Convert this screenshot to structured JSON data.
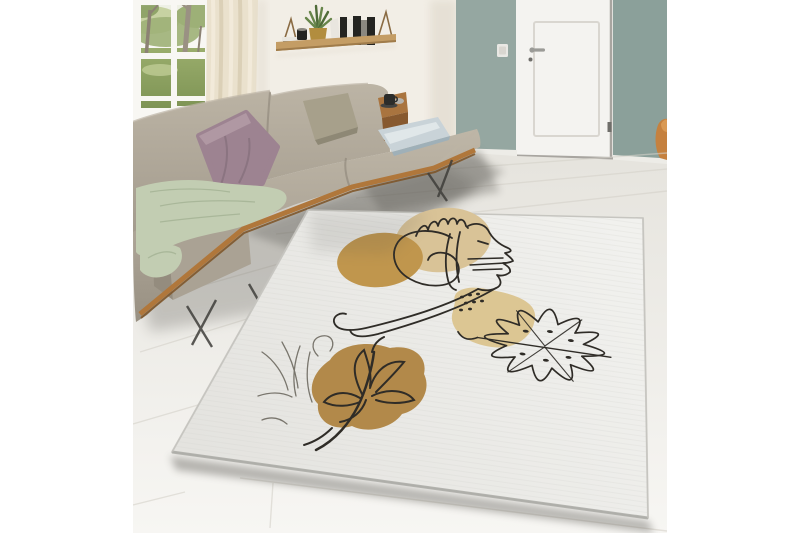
{
  "scene": {
    "setting": "bright living room lifestyle photo showcasing an abstract line-art area rug",
    "objects": {
      "window": "garden view with tree trunks and green lawn",
      "curtain": "cream linen curtain",
      "shelf": "hanging wooden wall shelf with books, succulent plant, gold pot and black canister",
      "sofa": "greige fabric corner sofa with wooden base rail and metal legs",
      "pillows": [
        "mauve velvet pillow",
        "sage-taupe pillow",
        "light blue satin pillow"
      ],
      "throw": "sage green knit throw",
      "side_table": "walnut side shelf with black espresso cup",
      "door": "white panel interior door with lever handle",
      "accent_wall": "sage-green recessed wall around door",
      "light_switch": "white switch on accent wall",
      "chair_glimpse": "orange wooden chair edge at right",
      "rug": {
        "shape": "rectangular rug seen in perspective",
        "ground": "off-white woven",
        "motifs": [
          "one-line woman face with hand over head",
          "ochre circle",
          "tan circle",
          "dotted beige blob",
          "monstera leaf outline",
          "camel blob with line-art lily and stem",
          "sketched wispy flower"
        ]
      }
    }
  },
  "palette": {
    "canvas": "#ffffff",
    "wall": "#f2eee6",
    "wall_shade": "#ddd6c8",
    "window_frame": "#f8f7f3",
    "frame_edge": "#d7d3c9",
    "sky": "#eef0e5",
    "foliage_light": "#c7d2a2",
    "foliage_mid": "#9db077",
    "foliage_dark": "#869c5f",
    "grass": "#93a768",
    "grass_light": "#c6d29b",
    "trunk": "#8c8274",
    "trunk_light": "#9a9183",
    "curtain": "#eae1cd",
    "curtain_fold": "#d8ccb2",
    "curtain_light": "#f4edde",
    "shelf_wood": "#c49d65",
    "shelf_wood_dark": "#a07c4b",
    "strap": "#8a6b43",
    "book_black": "#242421",
    "book_white": "#e9e6df",
    "book_gray": "#8b8880",
    "plant_green": "#67854a",
    "plant_green_dark": "#4f6b38",
    "pot_gold": "#b28d3e",
    "canister_black": "#232320",
    "teal_left": "#95a7a1",
    "teal_right": "#8ba09a",
    "baseboard": "#edece7",
    "door": "#f4f3f0",
    "door_panel_line": "#d9d6d0",
    "door_gap": "#a8a5a0",
    "handle_metal": "#9b9b97",
    "hinge": "#6f6e6a",
    "switch": "#e9e8e4",
    "chair_orange": "#c5813f",
    "chair_orange_light": "#d99a55",
    "plank_line": "#d5d2ca",
    "shadow": "#55534e",
    "sofa_light": "#bcb4a5",
    "sofa_mid": "#aaa294",
    "sofa_dark": "#948c7e",
    "sofa_seam": "#847c6f",
    "pillow_mauve": "#9d8391",
    "pillow_mauve_light": "#b59da8",
    "pillow_mauve_dark": "#7f6a77",
    "pillow_sage": "#a7a08b",
    "pillow_sage_dark": "#8e8875",
    "pillow_blue": "#c9d3d8",
    "pillow_blue_light": "#e4eaec",
    "pillow_blue_dark": "#9fb0b8",
    "throw_green": "#c2cdb2",
    "throw_green_dark": "#a3b294",
    "wood_trim": "#b0773b",
    "wood_trim_dark": "#7d5224",
    "table_wood": "#a9743f",
    "table_wood_dark": "#87592f",
    "cup_black": "#2c2c2a",
    "saucer": "#434341",
    "bowl_gray": "#b5b2ac",
    "metal_leg": "#3f3e3a",
    "rug_base": "#ececea",
    "rug_edge_line": "#a8a7a2",
    "rug_border_soft": "#c6c5c0",
    "circle_tan": "#d9c397",
    "circle_ochre": "#c0964d",
    "blob_tan": "#dcc693",
    "blob_camel": "#b2894a",
    "line_art": "#2f2c27",
    "sketch_gray": "#6e6a61"
  }
}
